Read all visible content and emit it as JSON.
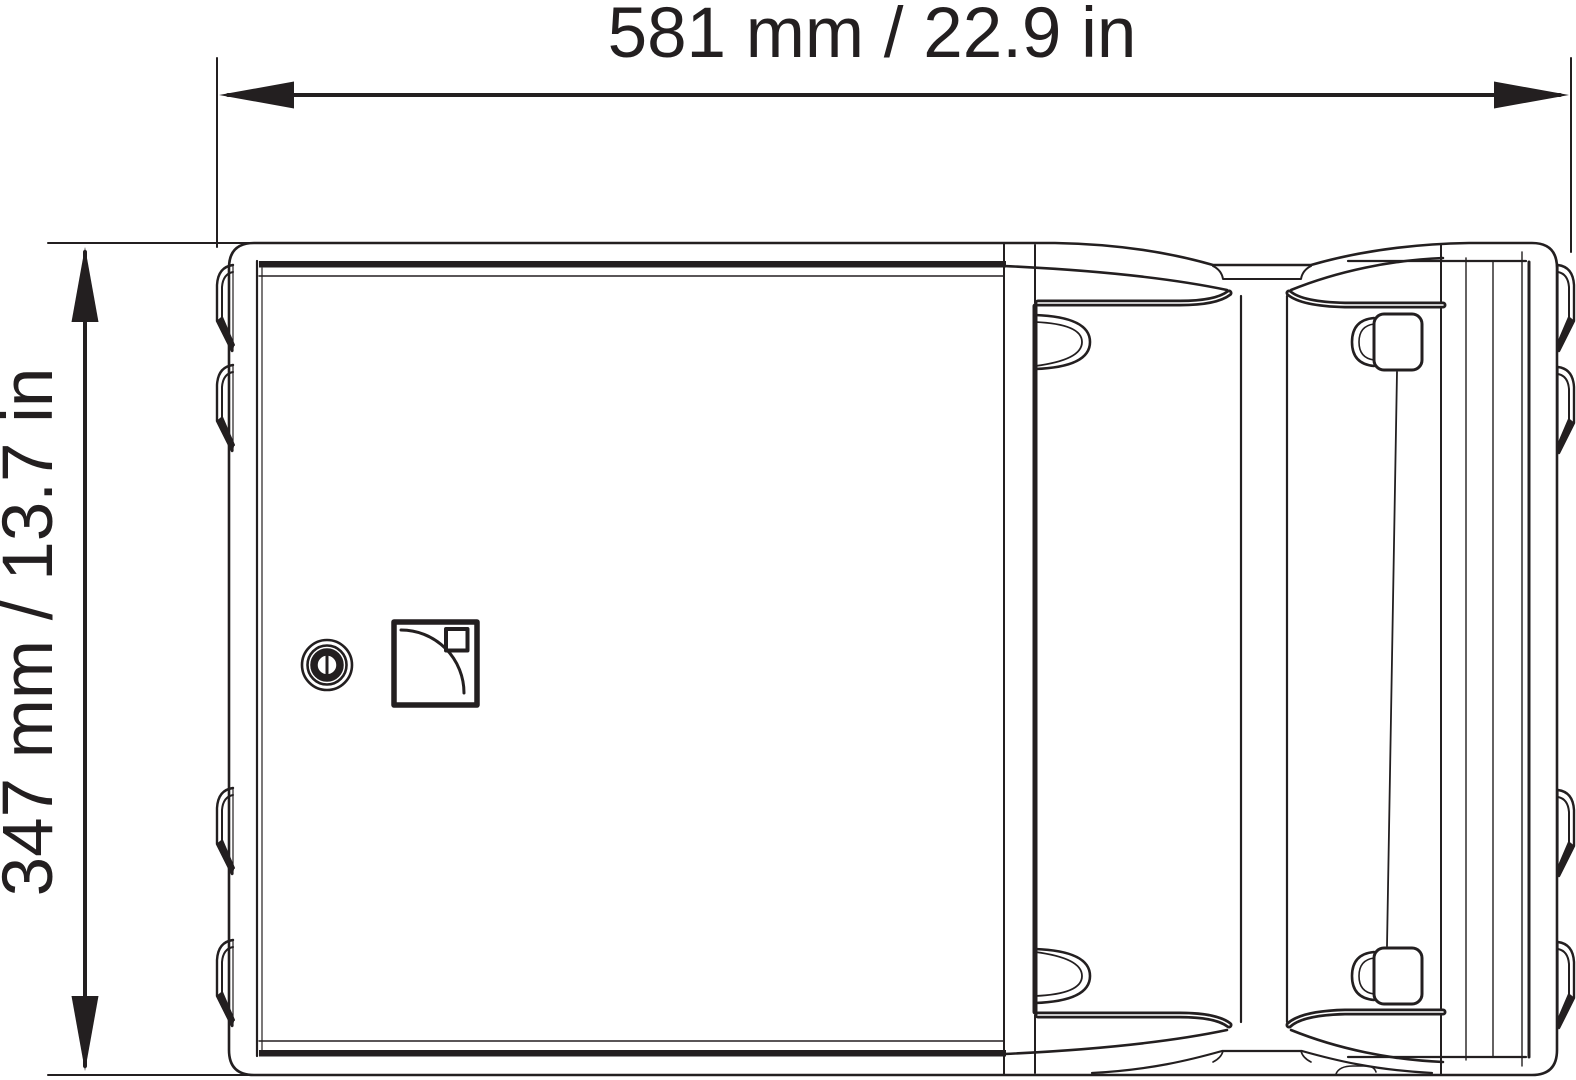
{
  "dimensions": {
    "width_label": "581 mm / 22.9 in",
    "height_label": "347 mm / 13.7 in"
  },
  "colors": {
    "line": "#231f20",
    "background": "#ffffff"
  },
  "icons": {
    "brand_logo": "quarter-circle-logo",
    "fastener": "slotted-screw-icon",
    "arrows": "dimension-arrowheads"
  }
}
